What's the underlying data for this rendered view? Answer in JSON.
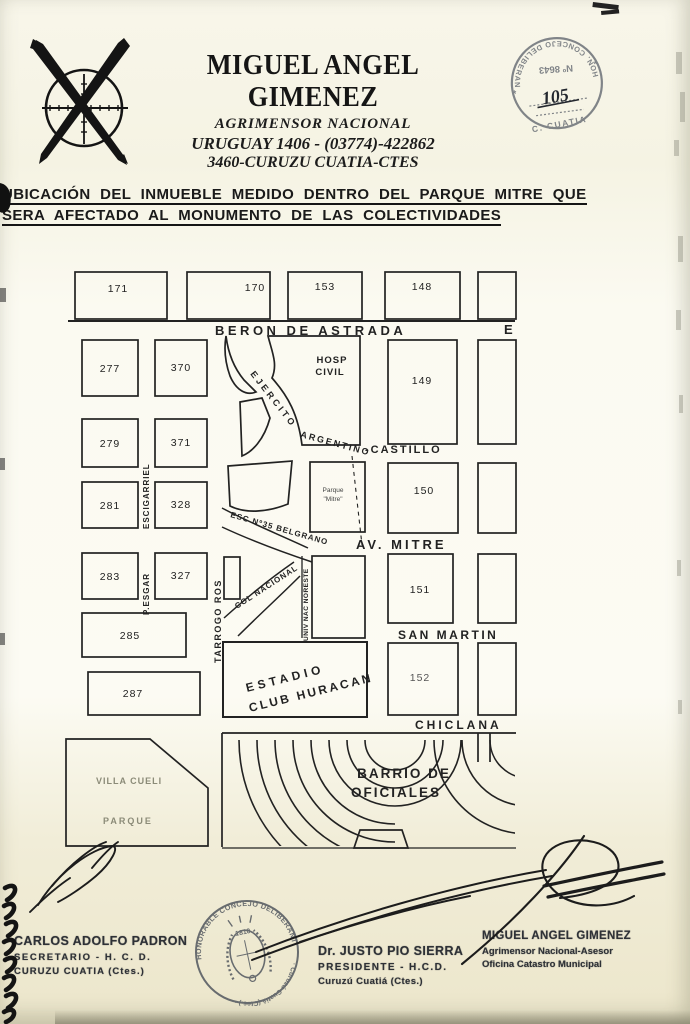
{
  "letterhead": {
    "name": "MIGUEL ANGEL GIMENEZ",
    "profession": "AGRIMENSOR NACIONAL",
    "address_phone": "URUGUAY 1406 - (03774)-422862",
    "city": "3460-CURUZU CUATIA-CTES",
    "logo_icon": "surveyor-crosshair-crossed-pens"
  },
  "stamp": {
    "ring_text": "HON. CONCEJO DELIBERANTE",
    "ring_bottom": "C. CUATIA",
    "number": "Nº 8643",
    "handwritten_number": "105",
    "star": "*",
    "ink_color": "#6b7077"
  },
  "title": {
    "line1": "UBICACIÓN DEL INMUEBLE MEDIDO DENTRO DEL PARQUE MITRE QUE",
    "line2": "SERA AFECTADO AL MONUMENTO DE LAS COLECTIVIDADES"
  },
  "map": {
    "streets": {
      "beron_de_astrada": "BERON DE ASTRADA",
      "beron_partial": "E",
      "ejercito": "EJERCITO",
      "argentino": "ARGENTINO",
      "castillo": "-CASTILLO",
      "av_mitre": "AV.  MITRE",
      "san_martin": "SAN  MARTIN",
      "chiclana": "CHICLANA",
      "esc_belgrano": "ESC Nº35 BELGRANO",
      "col_nacional": "COL NACIONAL",
      "tarrago_ros": "TARROGO ROS",
      "escigarriel": "ESCIGARRIEL",
      "pesgar": "P.ESGAR",
      "univ_nac": "UNIV NAC NORESTE"
    },
    "blocks": {
      "b171": "171",
      "b170": "170",
      "b153": "153",
      "b148": "148",
      "b277": "277",
      "b370": "370",
      "b279": "279",
      "b371": "371",
      "b281": "281",
      "b328": "328",
      "b283": "283",
      "b327": "327",
      "b285": "285",
      "b287": "287",
      "b149": "149",
      "b150": "150",
      "b151": "151",
      "b152": "152"
    },
    "labels": {
      "hosp_1": "HOSP",
      "hosp_2": "CIVIL",
      "parque_mitre_1": "Parque",
      "parque_mitre_2": "\"Mitre\"",
      "estadio_1": "ESTADIO",
      "estadio_2": "CLUB  HURACAN",
      "barrio_1": "BARRIO  DE",
      "barrio_2": "OFICIALES",
      "villa": "VILLA CUELI",
      "parque": "PARQUE"
    }
  },
  "signatories": {
    "secretary": {
      "name": "CARLOS ADOLFO PADRON",
      "role": "SECRETARIO - H. C. D.",
      "city": "CURUZU CUATIA (Ctes.)"
    },
    "president": {
      "name": "Dr. JUSTO PIO SIERRA",
      "role": "PRESIDENTE - H.C.D.",
      "city": "Curuzú Cuatiá (Ctes.)"
    },
    "surveyor": {
      "name": "MIGUEL ANGEL GIMENEZ",
      "role": "Agrimensor Nacional-Asesor",
      "office": "Oficina Catastro Municipal"
    }
  },
  "seal": {
    "ring_top": "HONORABLE CONCEJO DELIBERANTE",
    "ring_bottom": "· Curuzú Cuatiá (Ctes.) ·",
    "year": "1810",
    "ink_color": "#565b62"
  }
}
